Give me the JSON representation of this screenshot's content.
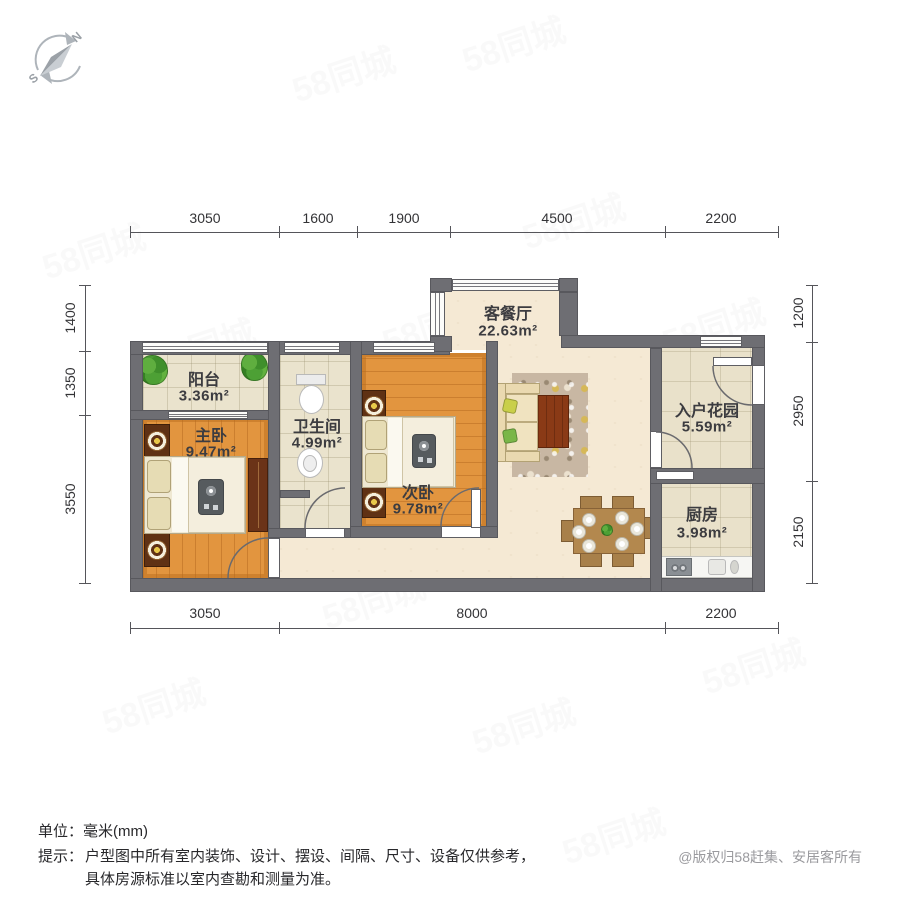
{
  "compass": {
    "north": "N",
    "south": "S"
  },
  "watermark": {
    "text": "58同城"
  },
  "dimensions": {
    "unit": "mm",
    "top": [
      "3050",
      "1600",
      "1900",
      "4500",
      "2200"
    ],
    "bottom": [
      "3050",
      "8000",
      "2200"
    ],
    "left": [
      "1400",
      "1350",
      "3550"
    ],
    "right": [
      "1200",
      "2950",
      "2150"
    ]
  },
  "rooms": {
    "living_dining": {
      "name": "客餐厅",
      "area": "22.63m²"
    },
    "balcony": {
      "name": "阳台",
      "area": "3.36m²"
    },
    "master_bedroom": {
      "name": "主卧",
      "area": "9.47m²"
    },
    "bathroom": {
      "name": "卫生间",
      "area": "4.99m²"
    },
    "second_bedroom": {
      "name": "次卧",
      "area": "9.78m²"
    },
    "entry_garden": {
      "name": "入户花园",
      "area": "5.59m²"
    },
    "kitchen": {
      "name": "厨房",
      "area": "3.98m²"
    }
  },
  "footer": {
    "unit_line": "单位：毫米(mm)",
    "tip_label": "提示：",
    "tip_line1": "户型图中所有室内装饰、设计、摆设、间隔、尺寸、设备仅供参考，",
    "tip_line2": "具体房源标准以室内查勘和测量为准。",
    "copyright": "@版权归58赶集、安居客所有"
  }
}
